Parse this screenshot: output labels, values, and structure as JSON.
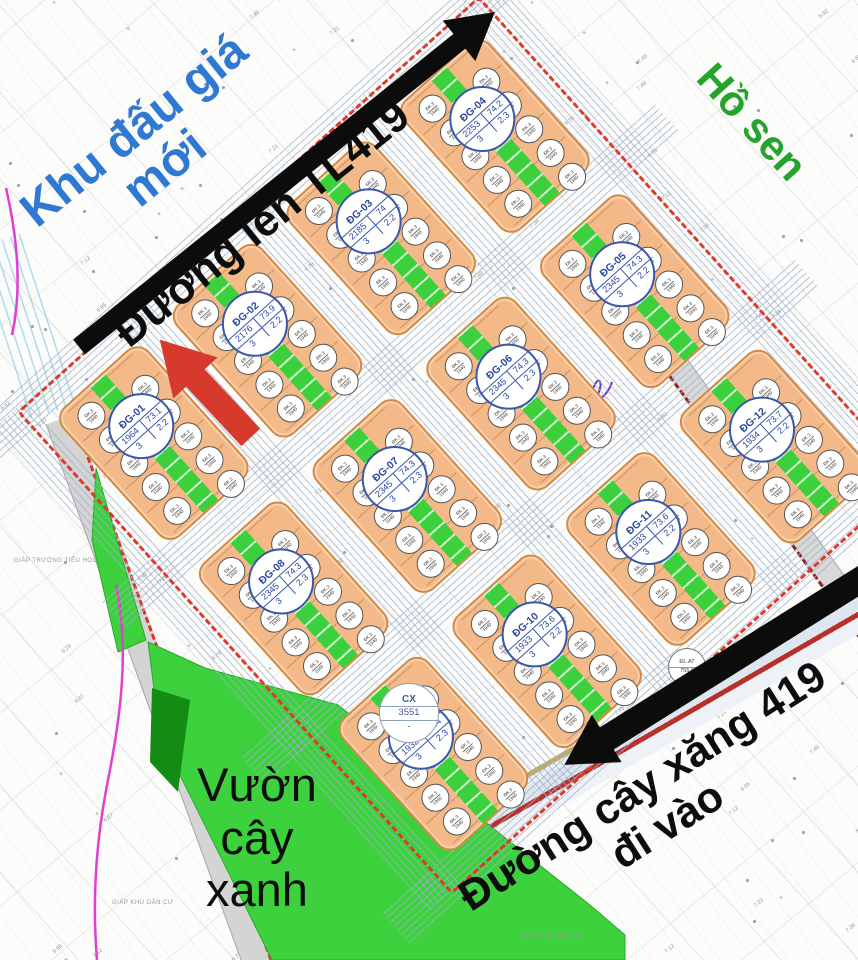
{
  "annotations": {
    "new_auction_area_lines": [
      "Khu đấu giá",
      "mới"
    ],
    "road_tl419": "Đường lên TL419",
    "lotus_lake": "Hồ sen",
    "green_garden_lines": [
      "Vườn",
      "cây",
      "xanh"
    ],
    "gas_road_lines": [
      "Đường cây xăng 419",
      "đi vào"
    ],
    "adjacent_school": "GIÁP TRƯỜNG TIỂU HỌC",
    "adjacent_residential": "GIÁP KHU DÂN CƯ"
  },
  "special_labels": {
    "cx": {
      "code": "CX",
      "area": "3551",
      "dash": "-"
    },
    "dlat": {
      "code": "ĐL.AT",
      "value": "755.9"
    }
  },
  "blocks": [
    {
      "name": "ĐG-01",
      "area": "1964",
      "frontage": "73.1",
      "row2a": "3",
      "row2b": "2.2",
      "grid": {
        "row": 0,
        "col": 0
      }
    },
    {
      "name": "ĐG-02",
      "area": "2176",
      "frontage": "73.9",
      "row2a": "3",
      "row2b": "2.2",
      "grid": {
        "row": 0,
        "col": 1
      }
    },
    {
      "name": "ĐG-03",
      "area": "2185",
      "frontage": "74",
      "row2a": "3",
      "row2b": "2.2",
      "grid": {
        "row": 0,
        "col": 2
      }
    },
    {
      "name": "ĐG-04",
      "area": "2253",
      "frontage": "74.2",
      "row2a": "3",
      "row2b": "2.3",
      "grid": {
        "row": 0,
        "col": 3
      }
    },
    {
      "name": "ĐG-08",
      "area": "2345",
      "frontage": "74.3",
      "row2a": "3",
      "row2b": "2.3",
      "grid": {
        "row": 1,
        "col": 0
      }
    },
    {
      "name": "ĐG-07",
      "area": "2345",
      "frontage": "74.3",
      "row2a": "3",
      "row2b": "2.3",
      "grid": {
        "row": 1,
        "col": 1
      }
    },
    {
      "name": "ĐG-06",
      "area": "2345",
      "frontage": "74.3",
      "row2a": "3",
      "row2b": "2.3",
      "grid": {
        "row": 1,
        "col": 2
      }
    },
    {
      "name": "ĐG-05",
      "area": "2345",
      "frontage": "74.3",
      "row2a": "3",
      "row2b": "2.2",
      "grid": {
        "row": 1,
        "col": 3
      }
    },
    {
      "name": "ĐG-09",
      "area": "1932",
      "frontage": "73.4",
      "row2a": "3",
      "row2b": "2.3",
      "grid": {
        "row": 2,
        "col": 0
      }
    },
    {
      "name": "ĐG-10",
      "area": "1933",
      "frontage": "73.6",
      "row2a": "3",
      "row2b": "2.2",
      "grid": {
        "row": 2,
        "col": 1
      }
    },
    {
      "name": "ĐG-11",
      "area": "1933",
      "frontage": "73.6",
      "row2a": "3",
      "row2b": "2.2",
      "grid": {
        "row": 2,
        "col": 2
      }
    },
    {
      "name": "ĐG-12",
      "area": "1934",
      "frontage": "73.7",
      "row2a": "3",
      "row2b": "2.2",
      "grid": {
        "row": 2,
        "col": 3
      }
    }
  ],
  "parcel_marker": {
    "line1": "ĐK.3",
    "line2": "1940"
  },
  "elevation_marks": [
    "7.48",
    "7.03",
    "6.92",
    "7.12",
    "6.87",
    "7.45",
    "6.95",
    "7.21",
    "6.78",
    "7.36"
  ],
  "colors": {
    "block_fill": "#f4b988",
    "block_border": "#d28a45",
    "green": "#3cd13c",
    "label_blue": "#2b47a0",
    "annotation_blue": "#3079d3",
    "annotation_green": "#25a42c",
    "arrow_red": "#d63a2c",
    "boundary_red": "#e0382a",
    "road_dark_red": "#9b2b23",
    "black": "#0c0c0c"
  }
}
